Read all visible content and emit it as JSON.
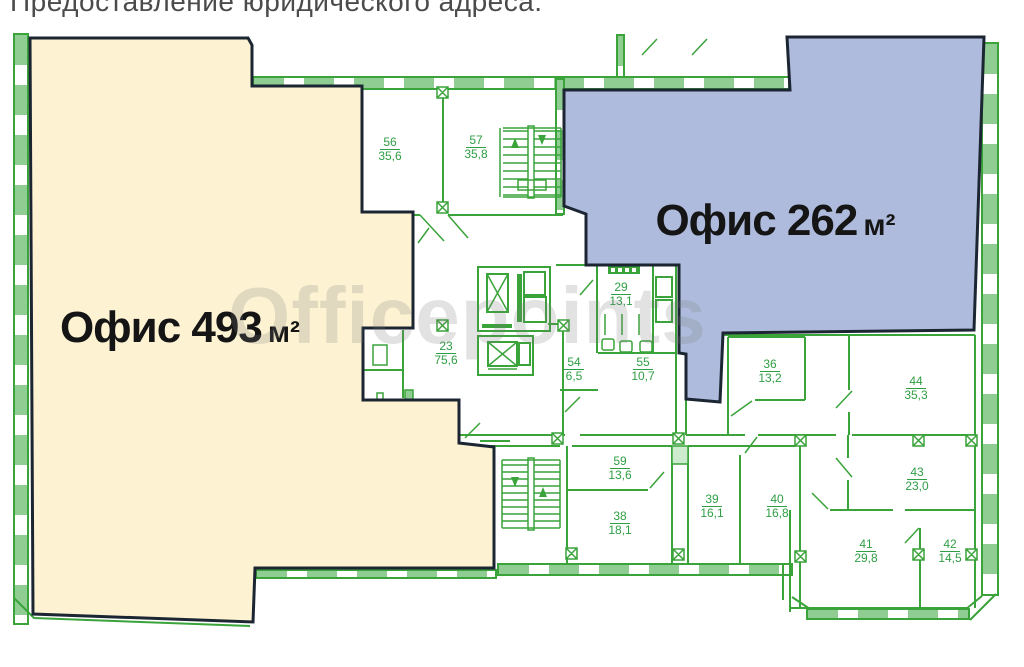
{
  "caption": "Предоставление юридического адреса.",
  "watermark": "Officepoints",
  "offices": [
    {
      "label": "Офис 493",
      "unit": "м²",
      "area_m2": "493"
    },
    {
      "label": "Офис 262",
      "unit": "м²",
      "area_m2": "262"
    }
  ],
  "rooms": [
    {
      "number": "56",
      "area": "35,6"
    },
    {
      "number": "57",
      "area": "35,8"
    },
    {
      "number": "29",
      "area": "13,1"
    },
    {
      "number": "23",
      "area": "75,6"
    },
    {
      "number": "54",
      "area": "6,5"
    },
    {
      "number": "55",
      "area": "10,7"
    },
    {
      "number": "36",
      "area": "13,2"
    },
    {
      "number": "44",
      "area": "35,3"
    },
    {
      "number": "43",
      "area": "23,0"
    },
    {
      "number": "59",
      "area": "13,6"
    },
    {
      "number": "38",
      "area": "18,1"
    },
    {
      "number": "39",
      "area": "16,1"
    },
    {
      "number": "40",
      "area": "16,8"
    },
    {
      "number": "41",
      "area": "29,8"
    },
    {
      "number": "42",
      "area": "14,5"
    }
  ],
  "colors": {
    "office_large_fill": "#fdf3d3",
    "office_small_fill": "#aebbdc",
    "plan_line": "#3aa33a",
    "wall_fill": "#8fcd92",
    "outline": "#1c2633",
    "room_label": "#2f9e44"
  }
}
